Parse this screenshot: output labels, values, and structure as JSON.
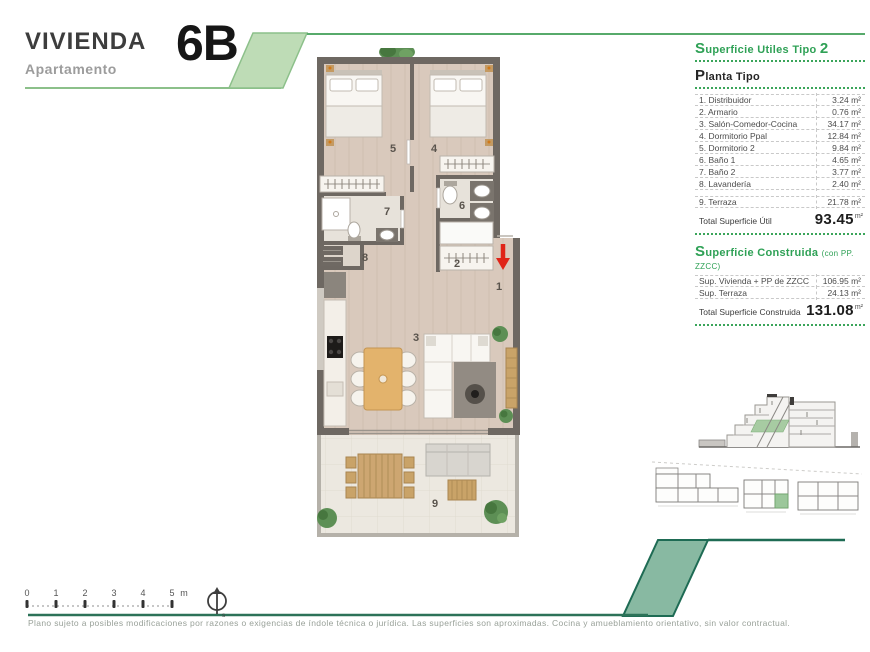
{
  "header": {
    "title": "VIVIENDA",
    "subtitle": "Apartamento",
    "unit": "6B"
  },
  "surface_table": {
    "title_main": "Superficie Utiles Tipo",
    "title_num": "2",
    "section_title": "Planta Tipo",
    "rows": [
      {
        "label": "1. Distribuidor",
        "value": "3.24 m²"
      },
      {
        "label": "2. Armario",
        "value": "0.76 m²"
      },
      {
        "label": "3. Salón-Comedor-Cocina",
        "value": "34.17 m²"
      },
      {
        "label": "4. Dormitorio Ppal",
        "value": "12.84 m²"
      },
      {
        "label": "5. Dormitorio 2",
        "value": "9.84 m²"
      },
      {
        "label": "6. Baño 1",
        "value": "4.65 m²"
      },
      {
        "label": "7. Baño 2",
        "value": "3.77 m²"
      },
      {
        "label": "8. Lavandería",
        "value": "2.40 m²"
      },
      {
        "label": "9. Terraza",
        "value": "21.78 m²"
      }
    ],
    "total_label": "Total Superficie Útil",
    "total_value": "93.45",
    "total_unit": "m²"
  },
  "built_table": {
    "title_main": "Superficie Construida",
    "title_suffix": "(con PP. ZZCC)",
    "rows": [
      {
        "label": "Sup. Vivienda + PP de ZZCC",
        "value": "106.95 m²"
      },
      {
        "label": "Sup. Terraza",
        "value": "24.13 m²"
      }
    ],
    "total_label": "Total Superficie Construida",
    "total_value": "131.08",
    "total_unit": "m²"
  },
  "plan": {
    "room_numbers": [
      "1",
      "2",
      "3",
      "4",
      "5",
      "6",
      "7",
      "8",
      "9"
    ]
  },
  "scale_bar": {
    "ticks": [
      "0",
      "1",
      "2",
      "3",
      "4",
      "5"
    ],
    "unit": "m"
  },
  "compass": {
    "label": "s"
  },
  "footer": {
    "disclaimer": "Plano sujeto a posibles modificaciones por razones o exigencias de índole técnica o jurídica. Las superficies son aproximadas. Cocina y amueblamiento orientativo, sin valor contractual."
  },
  "colors": {
    "accent_green": "#2fa156",
    "light_green_fill": "#bedcb6",
    "sage_band": "#88b9a2",
    "dark_teal": "#1e6b54",
    "wall_gray": "#6e6862",
    "wood_floor": "#d9c9bc",
    "terrace_floor": "#ece8e0",
    "arrow_red": "#e02418"
  }
}
